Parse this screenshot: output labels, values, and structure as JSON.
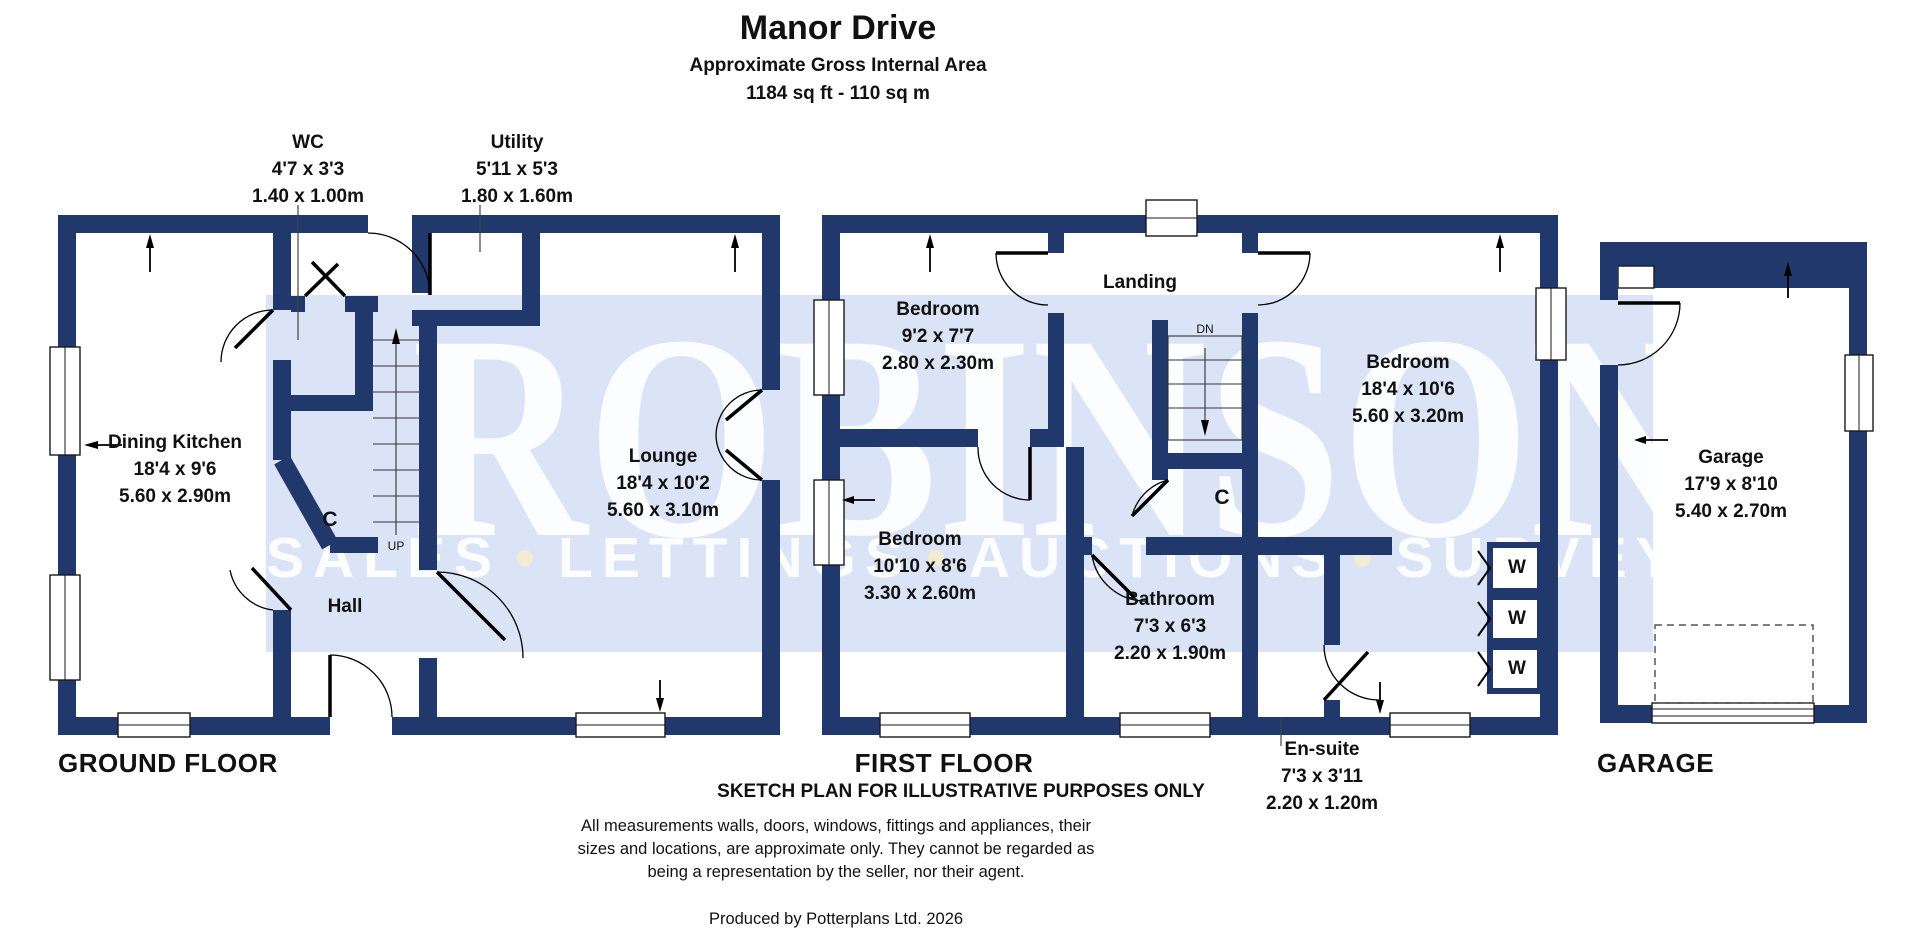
{
  "header": {
    "title": "Manor Drive",
    "subtitle": "Approximate Gross Internal Area",
    "area": "1184 sq ft - 110 sq m"
  },
  "watermark": {
    "name": "ROBINSONS",
    "bullet": "•",
    "tagline_parts": [
      "SALES",
      "LETTINGS",
      "AUCTIONS",
      "SURVEYS"
    ]
  },
  "floors": {
    "ground": {
      "label": "GROUND FLOOR"
    },
    "first": {
      "label": "FIRST FLOOR",
      "note": "SKETCH PLAN FOR ILLUSTRATIVE PURPOSES ONLY"
    },
    "garage": {
      "label": "GARAGE"
    }
  },
  "rooms": {
    "wc": {
      "name": "WC",
      "imperial": "4'7 x 3'3",
      "metric": "1.40 x 1.00m"
    },
    "utility": {
      "name": "Utility",
      "imperial": "5'11 x 5'3",
      "metric": "1.80 x 1.60m"
    },
    "dining_kitchen": {
      "name": "Dining Kitchen",
      "imperial": "18'4 x 9'6",
      "metric": "5.60 x 2.90m"
    },
    "lounge": {
      "name": "Lounge",
      "imperial": "18'4 x 10'2",
      "metric": "5.60 x 3.10m"
    },
    "hall": {
      "name": "Hall"
    },
    "landing": {
      "name": "Landing"
    },
    "bedroom1": {
      "name": "Bedroom",
      "imperial": "9'2 x 7'7",
      "metric": "2.80 x 2.30m"
    },
    "bedroom2": {
      "name": "Bedroom",
      "imperial": "10'10 x 8'6",
      "metric": "3.30 x 2.60m"
    },
    "bedroom3": {
      "name": "Bedroom",
      "imperial": "18'4 x 10'6",
      "metric": "5.60 x 3.20m"
    },
    "bathroom": {
      "name": "Bathroom",
      "imperial": "7'3 x 6'3",
      "metric": "2.20 x 1.90m"
    },
    "ensuite": {
      "name": "En-suite",
      "imperial": "7'3 x 3'11",
      "metric": "2.20 x 1.20m"
    },
    "garage": {
      "name": "Garage",
      "imperial": "17'9 x 8'10",
      "metric": "5.40 x 2.70m"
    }
  },
  "annotations": {
    "up": "UP",
    "dn": "DN",
    "cupboard": "C",
    "wardrobe": "W"
  },
  "footer": {
    "disclaimer_lines": [
      "All measurements walls, doors, windows, fittings and appliances, their",
      "sizes and locations, are approximate only. They cannot be regarded as",
      "being a representation by the seller, nor their agent."
    ],
    "credit": "Produced by Potterplans Ltd. 2026"
  },
  "colors": {
    "wall": "#20386b",
    "band": "#dbe4f7",
    "bullet": "#f2ecd2"
  }
}
